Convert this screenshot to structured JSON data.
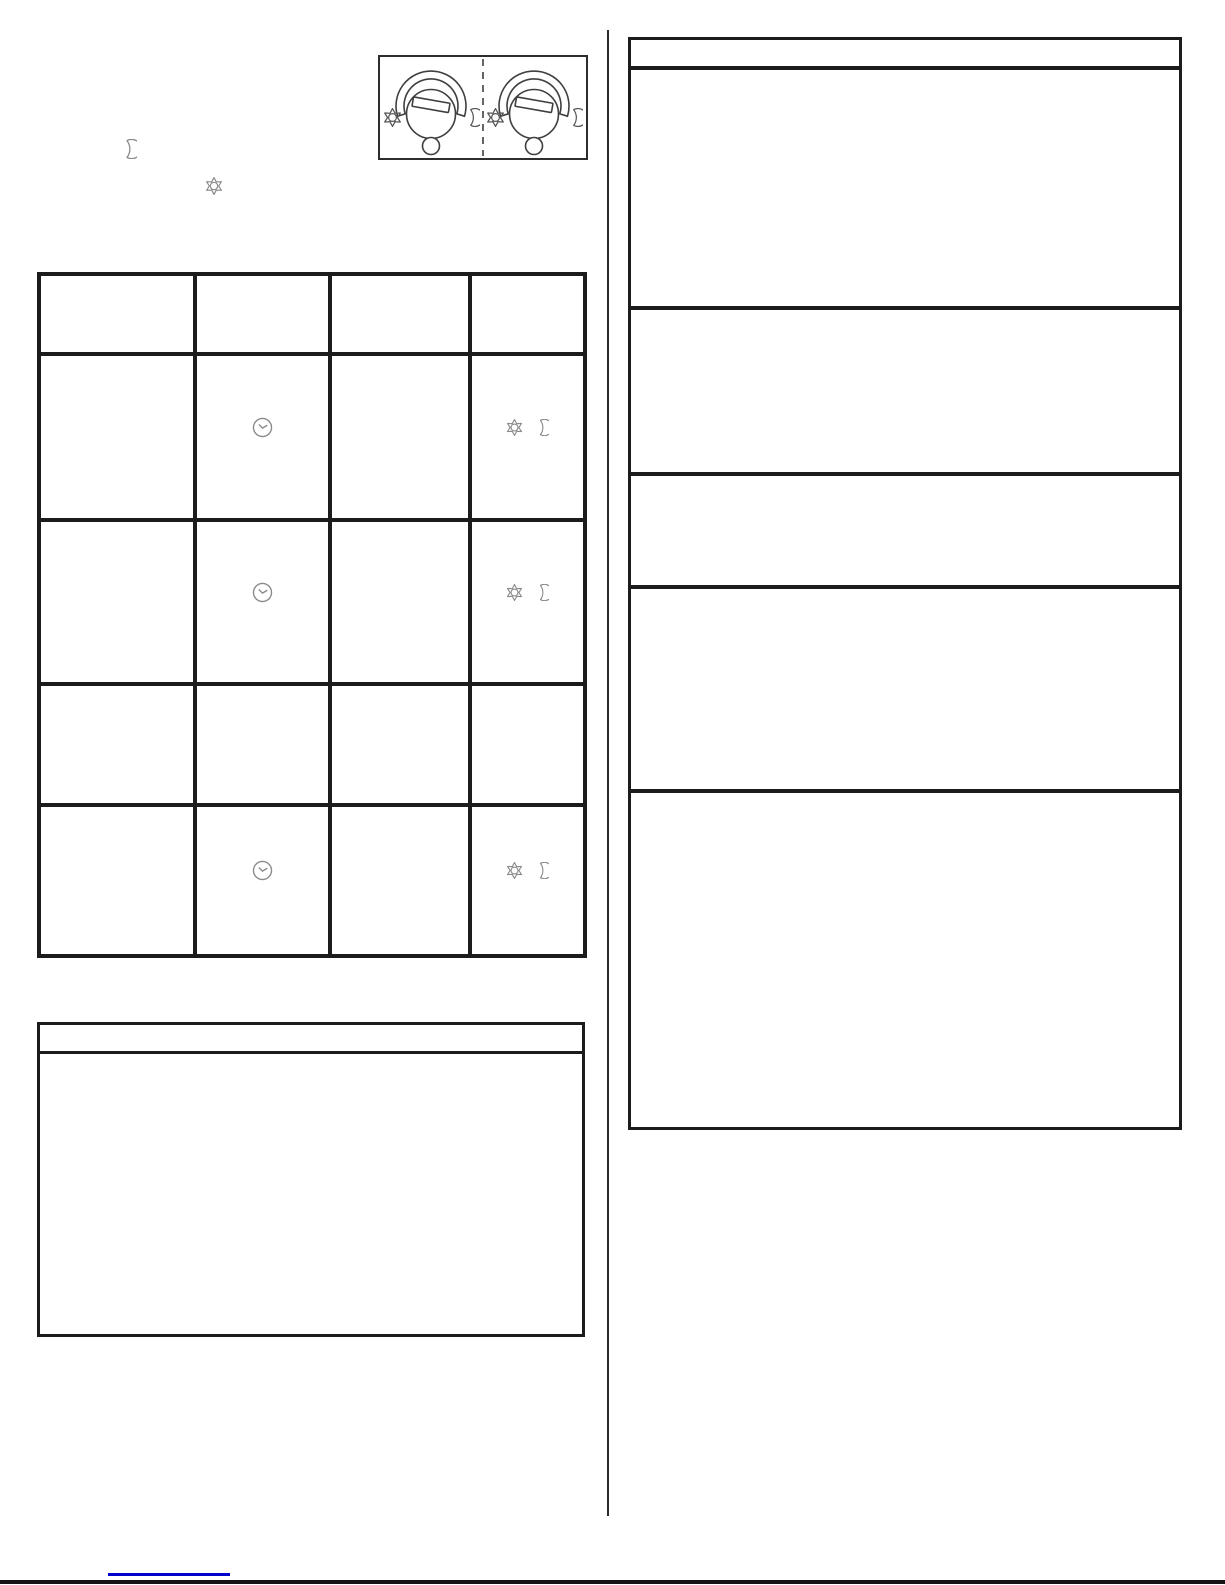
{
  "page": {
    "background": "#ffffff",
    "visible_text": "",
    "note": "scanned manual page; graphics and icons only, no rendered text"
  },
  "colors": {
    "table_border": "#1c1c1c",
    "diagram_stroke": "#3f3f3f",
    "icon_stroke": "#8a8a8a",
    "link_blue": "#0000cc",
    "footer_rule": "#141414",
    "page_bg": "#ffffff"
  },
  "intro": {
    "icons": [
      "moon-icon",
      "sun-icon"
    ]
  },
  "dial_diagram": {
    "divider_style": "dashed",
    "panels": [
      {
        "scale": "arc",
        "knob": "slotted-dial",
        "left_icon": "sun-icon",
        "right_icon": "moon-icon",
        "indicator": "circle"
      },
      {
        "scale": "arc",
        "knob": "slotted-dial",
        "left_icon": "sun-icon",
        "right_icon": "moon-icon",
        "indicator": "circle"
      }
    ]
  },
  "settings_table": {
    "column_count": 4,
    "rows": [
      {
        "type": "header",
        "cells": [
          "",
          "",
          "",
          ""
        ]
      },
      {
        "type": "data",
        "cells": [
          "",
          "clock-icon",
          "",
          "sun-icon + moon-icon"
        ]
      },
      {
        "type": "data",
        "cells": [
          "",
          "clock-icon",
          "",
          "sun-icon + moon-icon"
        ]
      },
      {
        "type": "data",
        "cells": [
          "",
          "",
          "",
          ""
        ]
      },
      {
        "type": "data",
        "cells": [
          "",
          "clock-icon",
          "",
          "sun-icon + moon-icon"
        ]
      }
    ]
  },
  "note_box": {
    "has_header_strip": true,
    "body_text": ""
  },
  "info_table": {
    "has_header_strip": true,
    "row_count": 5,
    "rows": [
      {
        "text": ""
      },
      {
        "text": ""
      },
      {
        "text": ""
      },
      {
        "text": ""
      },
      {
        "text": ""
      }
    ]
  },
  "footer": {
    "link_text": "",
    "link_style": "blue-underline"
  }
}
